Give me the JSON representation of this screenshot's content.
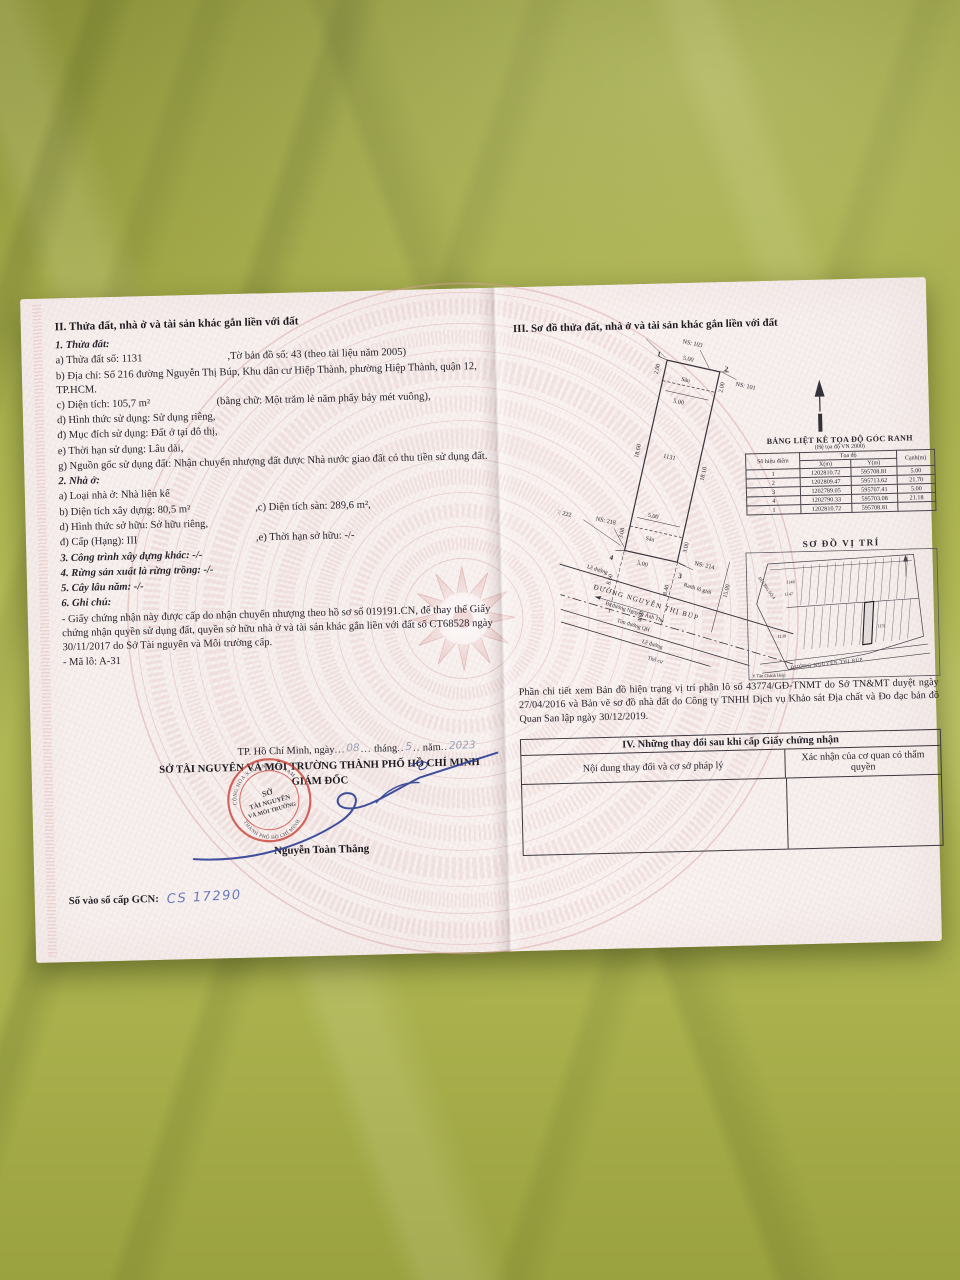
{
  "doc": {
    "left": {
      "section2_title": "II. Thửa đất, nhà ở và tài sản khác gắn liền với đất",
      "t1_title": "1. Thửa đất:",
      "t1a": "a) Thửa đất số:  1131",
      "t1a2": ",Tờ bản đồ số: 43 (theo tài liệu năm 2005)",
      "t1b": "b) Địa chỉ: Số 216 đường Nguyễn Thị Búp, Khu dân cư Hiệp Thành, phường Hiệp Thành, quận 12, TP.HCM.",
      "t1c": "c) Diện tích:   105,7 m²",
      "t1c2": "(bằng chữ: Một trăm lẻ năm phẩy bảy mét vuông),",
      "t1d": "d) Hình thức sử dụng: Sử dụng riêng,",
      "t1dd": "đ) Mục đích sử dụng: Đất ở tại đô thị,",
      "t1e": "e) Thời hạn sử dụng: Lâu dài,",
      "t1g": "g) Nguồn gốc sử dụng đất: Nhận chuyển nhượng đất được Nhà nước giao đất có thu tiền sử dụng đất.",
      "t2_title": "2. Nhà ở:",
      "t2a": "a) Loại nhà ở: Nhà liên kế",
      "t2b": "b) Diện tích xây dựng:   80,5 m²",
      "t2c": ",c) Diện tích sàn: 289,6 m²,",
      "t2d": "d) Hình thức sở hữu:  Sở hữu riêng,",
      "t2dd": "đ) Cấp (Hạng): III",
      "t2e": ",e) Thời hạn sở hữu: -/-",
      "t3": "3. Công trình xây dựng khác: -/-",
      "t4": "4. Rừng sản xuất là rừng trồng: -/-",
      "t5": "5. Cây lâu năm: -/-",
      "t6": "6. Ghi chú:",
      "note1": "- Giấy chứng nhận này được cấp do nhận chuyển nhượng theo hồ sơ số 019191.CN, để thay thế Giấy chứng nhận quyền sử dụng đất, quyền sở hữu nhà ở và tài sản khác gắn liền với đất số CT68528 ngày 30/11/2017 do Sở Tài nguyên và Môi trường cấp.",
      "note2": "- Mã lô: A-31"
    },
    "right": {
      "section3_title": "III. Sơ đồ thửa đất, nhà ở và tài sản khác gắn liền với đất",
      "diagram": {
        "ns105": "NS: 105",
        "ns103": "NS: 103",
        "ns101": "NS: 101",
        "ns222": "NS: 222",
        "ns218": "NS: 218",
        "ns214": "NS: 214",
        "p1": "1",
        "p2": "2",
        "p3": "3",
        "p4": "4",
        "lot": "1131",
        "d200": "2.00",
        "d500": "5.00",
        "san": "Sân",
        "d1860": "18.60",
        "d1810": "18.10",
        "d308": "3.08",
        "d300": "3.00",
        "d860": "8.60",
        "d840": "8.40",
        "d1500": "15.00",
        "d460": "4.60",
        "ranh": "Ranh lộ giới",
        "le": "Lề đường",
        "road": "ĐƯỜNG NGUYỄN THỊ BÚP",
        "di": "Đi đường Nguyễn Ảnh Thủ",
        "tim": "Tim đường QH",
        "thocu": "Thổ cư"
      },
      "coord_table": {
        "title": "BẢNG LIỆT KÊ TỌA ĐỘ GÓC RANH",
        "subtitle": "(Hệ tọa độ VN 2000)",
        "col_point": "Số hiệu điểm",
        "col_coord": "Tọa độ",
        "col_x": "X(m)",
        "col_y": "Y(m)",
        "col_edge": "Cạnh(m)",
        "rows": [
          [
            "1",
            "1202810.72",
            "595708.81",
            "5.00"
          ],
          [
            "2",
            "1202809.47",
            "595713.62",
            "21.70"
          ],
          [
            "3",
            "1202789.05",
            "595707.41",
            "5.00"
          ],
          [
            "4",
            "1202790.33",
            "595703.08",
            "21.18"
          ],
          [
            "1",
            "1202810.72",
            "595708.81",
            ""
          ]
        ]
      },
      "vitri": {
        "title": "SƠ ĐỒ VỊ TRÍ",
        "lot1148": "1148",
        "lot1147": "1147",
        "lot1139": "1139",
        "lot1131": "1131",
        "road_bottom": "ĐƯỜNG NGUYỄN THỊ BÚP",
        "road_left": "ĐƯỜNG SỐ 4",
        "ward": "P. Tân Chánh Hiệp"
      },
      "note": "Phần chi tiết xem Bản đồ hiện trạng vị trí phân lô số 43774/GĐ-TNMT do Sở TN&MT duyệt ngày 27/04/2016 và Bản vẽ sơ đồ nhà đất do Công ty TNHH Dịch vụ Khảo sát Địa chất và Đo đạc bản đồ Quan San lập ngày 30/12/2019.",
      "section4": {
        "title": "IV. Những thay đổi sau khi cấp Giấy chứng nhận",
        "col1": "Nội dung thay đổi và cơ sở pháp lý",
        "col2": "Xác nhận của cơ quan có thẩm quyền"
      }
    },
    "sig": {
      "date_prefix": "TP. Hồ Chí Minh, ngày",
      "dots_a": "...",
      "date_day": "08",
      "date_mid1": "tháng",
      "dots_b": "..",
      "date_month": "5",
      "date_mid2": "năm",
      "dots_c": "..",
      "date_year": "2023",
      "agency": "SỞ TÀI NGUYÊN VÀ MÔI TRƯỜNG THÀNH PHỐ HỒ CHÍ MINH",
      "role": "GIÁM ĐỐC",
      "signer": "Nguyễn Toàn Thắng",
      "stamp_line1": "SỞ",
      "stamp_line2": "TÀI NGUYÊN",
      "stamp_line3": "VÀ MÔI TRƯỜNG",
      "stamp_ring_top": "CỘNG HÒA X.H.C.N VIỆT NAM",
      "stamp_ring_bottom": "THÀNH PHỐ HỒ CHÍ MINH",
      "book_label": "Số vào sổ cấp GCN:",
      "book_value": "CS 17290"
    }
  }
}
